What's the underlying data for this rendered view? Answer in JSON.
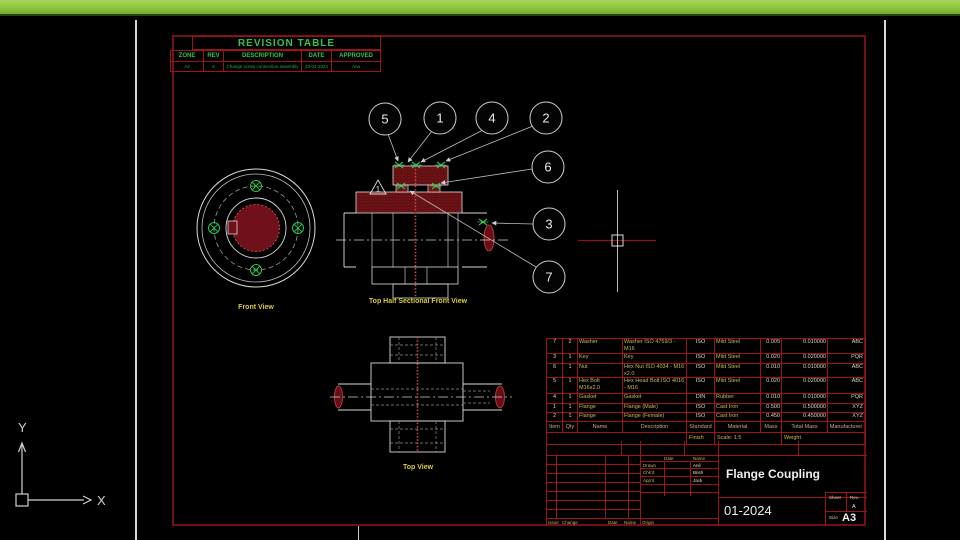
{
  "revision_table": {
    "title": "REVISION TABLE",
    "headers": [
      "ZONE",
      "REV",
      "DESCRIPTION",
      "DATE",
      "APPROVED"
    ],
    "row": {
      "zone": "A2",
      "rev": "5",
      "description": "Change screw connection assembly",
      "date": "23-01-2024",
      "approved": "Ana"
    }
  },
  "views": {
    "front_view_label": "Front View",
    "sectional_view_label": "Top Half Sectional Front View",
    "top_view_label": "Top View",
    "revision_marker": "1"
  },
  "balloons": [
    "5",
    "1",
    "4",
    "2",
    "6",
    "3",
    "7"
  ],
  "bom": {
    "headers": [
      "Item",
      "Qty",
      "Name",
      "Description",
      "Standard",
      "Material",
      "Mass",
      "Total Mass",
      "Manufacturer"
    ],
    "rows": [
      {
        "item": "7",
        "qty": "2",
        "name": "Washer",
        "description": "Washer ISO 4759/3 - M16",
        "standard": "ISO",
        "material": "Mild Steel",
        "mass": "0.005",
        "total_mass": "0.010000",
        "manufacturer": "ABC"
      },
      {
        "item": "3",
        "qty": "1",
        "name": "Key",
        "description": "Key",
        "standard": "ISO",
        "material": "Mild Steel",
        "mass": "0.020",
        "total_mass": "0.020000",
        "manufacturer": "PQR"
      },
      {
        "item": "6",
        "qty": "1",
        "name": "Nut",
        "description": "Hex Nut ISO 4034 - M16 x2.0",
        "standard": "ISO",
        "material": "Mild Steel",
        "mass": "0.010",
        "total_mass": "0.010000",
        "manufacturer": "ABC"
      },
      {
        "item": "5",
        "qty": "1",
        "name": "Hex Bolt M16x2.0",
        "description": "Hex Head Bolt ISO 4016 - M16",
        "standard": "ISO",
        "material": "Mild Steel",
        "mass": "0.020",
        "total_mass": "0.020000",
        "manufacturer": "ABC"
      },
      {
        "item": "4",
        "qty": "1",
        "name": "Gasket",
        "description": "Gasket",
        "standard": "DIN",
        "material": "Rubber",
        "mass": "0.010",
        "total_mass": "0.010000",
        "manufacturer": "PQR"
      },
      {
        "item": "1",
        "qty": "1",
        "name": "Flange",
        "description": "Flange (Male)",
        "standard": "ISO",
        "material": "Cast Iron",
        "mass": "0.500",
        "total_mass": "0.500000",
        "manufacturer": "XYZ"
      },
      {
        "item": "2",
        "qty": "1",
        "name": "Flange",
        "description": "Flange (Female)",
        "standard": "ISO",
        "material": "Cast Iron",
        "mass": "0.450",
        "total_mass": "0.450000",
        "manufacturer": "XYZ"
      }
    ],
    "footer": {
      "finish_label": "Finish",
      "scale": "Scale: 1:5",
      "weight_label": "Weight"
    }
  },
  "title_block": {
    "date_header": "Date",
    "name_header": "Name",
    "drawn_label": "Drawn",
    "drawn_name": "Anil",
    "checked_label": "Chk'd",
    "checked_name": "Brish",
    "approved_label": "App'd",
    "approved_name": "Jack",
    "title": "Flange Coupling",
    "date": "01-2024",
    "sheet_label": "Sheet",
    "rev_label": "Rev.",
    "rev_value": "A",
    "size_label": "Size",
    "size_value": "A3",
    "footer_labels": [
      "Issue",
      "Change",
      "Date",
      "Name",
      "Origin"
    ]
  },
  "ucs": {
    "x_label": "X",
    "y_label": "Y"
  },
  "colors": {
    "top_bar": "#8cc63e",
    "sheet_lines": "#9e1317",
    "section_hatch": "#5e0e11",
    "entity_green": "#2ec04e",
    "label_yellow": "#d8ca3a",
    "geometry_white": "#d9d9d9"
  }
}
